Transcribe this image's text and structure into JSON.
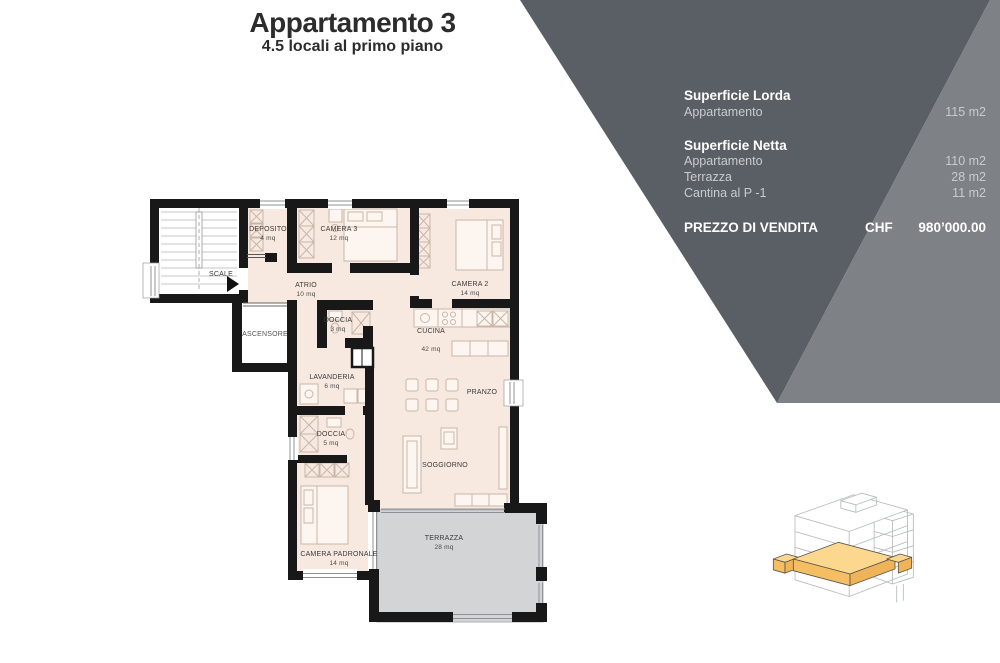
{
  "title": {
    "main": "Appartamento 3",
    "subtitle": "4.5 locali al primo piano"
  },
  "info_panel": {
    "colors": {
      "panel_dark": "#5a5f65",
      "panel_light": "#7e8287",
      "text_primary": "#ffffff",
      "text_secondary": "#c9ccce"
    },
    "sections": [
      {
        "heading": "Superficie Lorda",
        "rows": [
          {
            "label": "Appartamento",
            "value": "115 m2"
          }
        ]
      },
      {
        "heading": "Superficie Netta",
        "rows": [
          {
            "label": "Appartamento",
            "value": "110 m2"
          },
          {
            "label": "Terrazza",
            "value": "28 m2"
          },
          {
            "label": "Cantina al P -1",
            "value": "11 m2"
          }
        ]
      }
    ],
    "price": {
      "label": "PREZZO DI VENDITA",
      "currency": "CHF",
      "amount": "980’000.00"
    }
  },
  "floorplan": {
    "colors": {
      "floor": "#f8e9e0",
      "terrace": "#d2d4d6",
      "wall": "#181818",
      "furniture": "#c9b6a8"
    },
    "rooms": [
      {
        "name": "SCALE",
        "area": ""
      },
      {
        "name": "DEPOSITO",
        "area": "4 mq"
      },
      {
        "name": "CAMERA 3",
        "area": "12 mq"
      },
      {
        "name": "ATRIO",
        "area": "10 mq"
      },
      {
        "name": "CAMERA 2",
        "area": "14 mq"
      },
      {
        "name": "ASCENSORE",
        "area": ""
      },
      {
        "name": "DOCCIA",
        "area": "3 mq"
      },
      {
        "name": "CUCINA",
        "area": "42 mq"
      },
      {
        "name": "LAVANDERIA",
        "area": "6 mq"
      },
      {
        "name": "PRANZO",
        "area": ""
      },
      {
        "name": "DOCCIA",
        "area": "5 mq"
      },
      {
        "name": "SOGGIORNO",
        "area": ""
      },
      {
        "name": "CAMERA PADRONALE",
        "area": "14 mq"
      },
      {
        "name": "TERRAZZA",
        "area": "28 mq"
      }
    ]
  },
  "locator": {
    "wireframe_color": "#b6babd",
    "highlight_top": "#fcd88e",
    "highlight_front": "#f5be62"
  }
}
